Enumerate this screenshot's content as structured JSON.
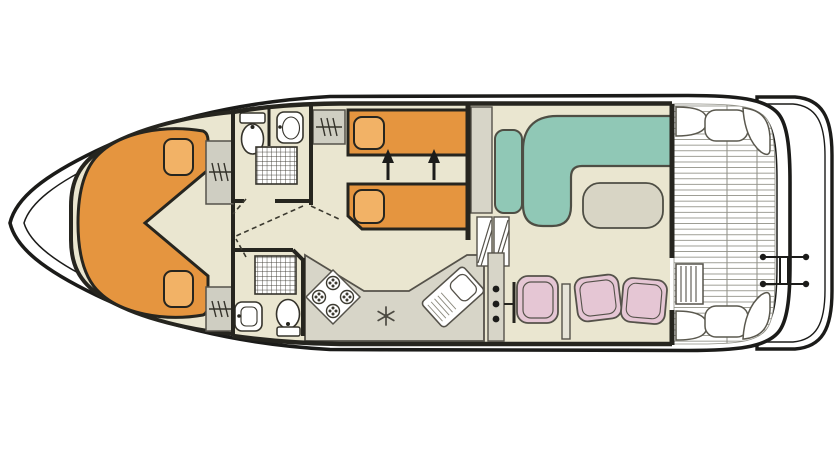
{
  "diagram": {
    "type": "boat-floor-plan",
    "view": "top-down deck plan of a canal cruiser"
  },
  "colors": {
    "hull_line": "#1b1b19",
    "wall": "#26251f",
    "floor": "#eae6d0",
    "bed": "#e5953f",
    "pillow": "#f2b266",
    "sofa": "#90c8b6",
    "chair": "#e5c6d4",
    "cabinet": "#cfcec2",
    "counter": "#d7d5c8",
    "table": "#d8d5c5",
    "fixture": "#ffffff",
    "soft_outline": "#55524a",
    "plank_line": "#8e8e84",
    "glyph": "#35332b"
  },
  "rooms": [
    {
      "name": "bow-cabin",
      "furniture": [
        "v-berth-double-bed",
        "pillow",
        "pillow",
        "wardrobe",
        "wardrobe"
      ]
    },
    {
      "name": "fore-bathroom",
      "furniture": [
        "toilet",
        "washbasin",
        "shower"
      ]
    },
    {
      "name": "aft-bathroom",
      "furniture": [
        "shower",
        "washbasin",
        "toilet"
      ]
    },
    {
      "name": "twin-cabin",
      "furniture": [
        "single-bed",
        "single-bed",
        "wardrobe",
        "slide-together-arrow",
        "slide-together-arrow"
      ]
    },
    {
      "name": "galley",
      "furniture": [
        "hob-four-burners",
        "refrigerator-snowflake",
        "sink-with-drainer",
        "worktop"
      ]
    },
    {
      "name": "saloon",
      "furniture": [
        "l-shaped-sofa",
        "side-seat",
        "table",
        "helm-console",
        "helm-seat",
        "dining-chair",
        "dining-chair",
        "steps"
      ]
    },
    {
      "name": "aft-deck",
      "furniture": [
        "deck-planking",
        "corner-bench",
        "corner-bench",
        "corner-bench",
        "corner-bench",
        "deck-locker",
        "deck-locker",
        "ladder"
      ]
    },
    {
      "name": "swim-platform",
      "furniture": [
        "boarding-bracket"
      ]
    }
  ]
}
